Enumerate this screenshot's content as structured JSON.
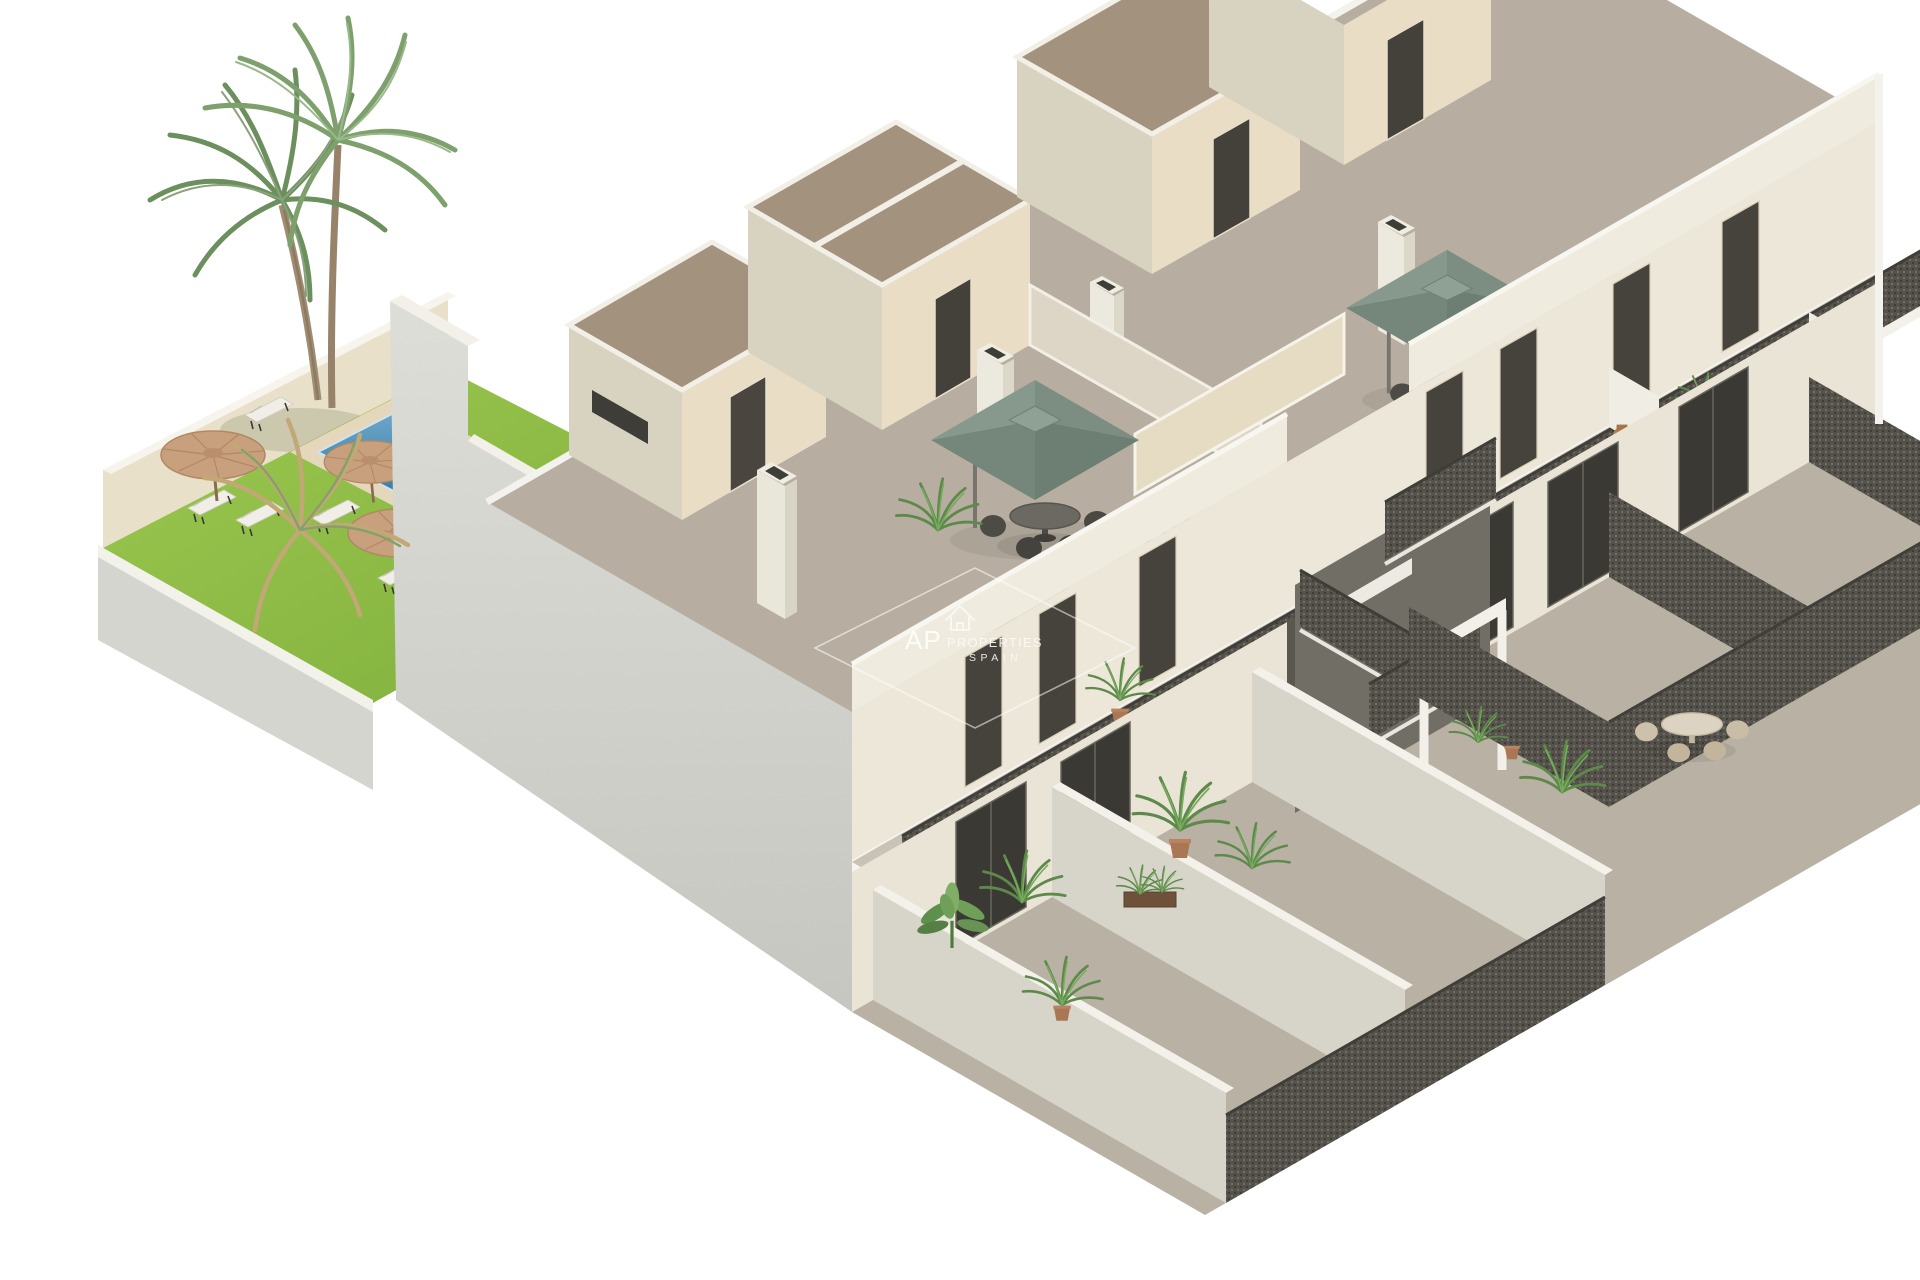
{
  "page": {
    "background": "#ffffff"
  },
  "render": {
    "alt_text": "Isometric cutaway 3D render of a two-storey apartment building with roof solarium terraces, central lattice staircase, front patios, communal garden with lawn, swimming pool, straw parasols, sun loungers and palm trees",
    "elements": {
      "palm_trees": 2,
      "straw_parasols": 3,
      "sun_loungers": 6,
      "green_parasols": 2,
      "outdoor_dining_sets": 3,
      "swimming_pools": 1,
      "building_levels": 3,
      "roof_bulkheads": 4,
      "chimneys": 4
    }
  },
  "watermark": {
    "icon": "house-outline-icon",
    "brand_initials": "AP",
    "brand_word": "PROPERTIES",
    "country_word": "SPAIN"
  },
  "colors": {
    "background": "#ffffff",
    "lawn_green": "#93c24a",
    "pool_water": "#3f82ab",
    "pool_deck": "#e5d7bb",
    "straw_parasol": "#c79e7c",
    "green_parasol": "#7c8d82",
    "west_wall": "#d3d3ce",
    "facade_cream": "#ece7d9",
    "bulkhead_beige": "#e9ddc5",
    "flat_roof_brown": "#a3937e",
    "terrace_floor": "#b7aea1",
    "railing_dark": "#55524b",
    "door_dark": "#413e38",
    "white_trim": "#f4f2ec",
    "plant_green": "#5d8a4a"
  }
}
